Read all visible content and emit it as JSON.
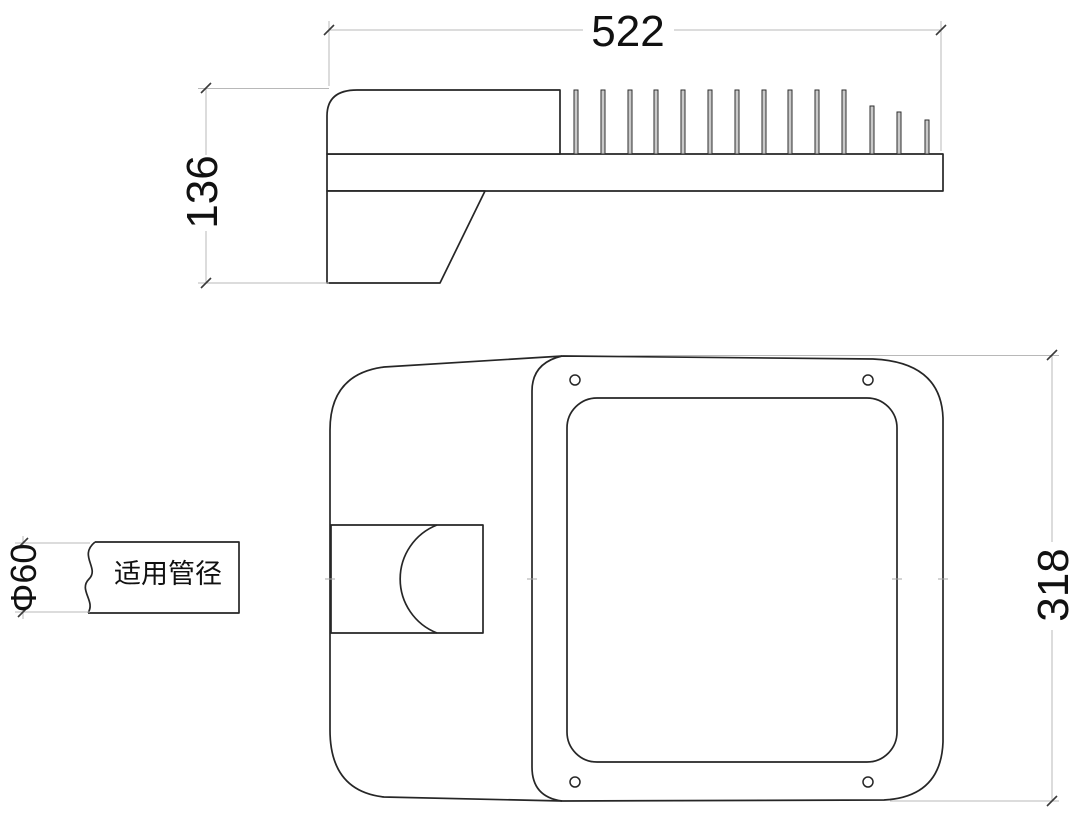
{
  "drawing": {
    "side_view": {
      "width_label": "522",
      "height_label": "136"
    },
    "plan_view": {
      "depth_label": "318"
    },
    "pipe_callout": {
      "diameter_label": "Φ60",
      "note_label": "适用管径"
    },
    "colors": {
      "background": "#ffffff",
      "outline": "#262626",
      "dimension_line": "#b8b8b8",
      "fin_fill": "#c9c9c9",
      "text": "#111111"
    }
  }
}
